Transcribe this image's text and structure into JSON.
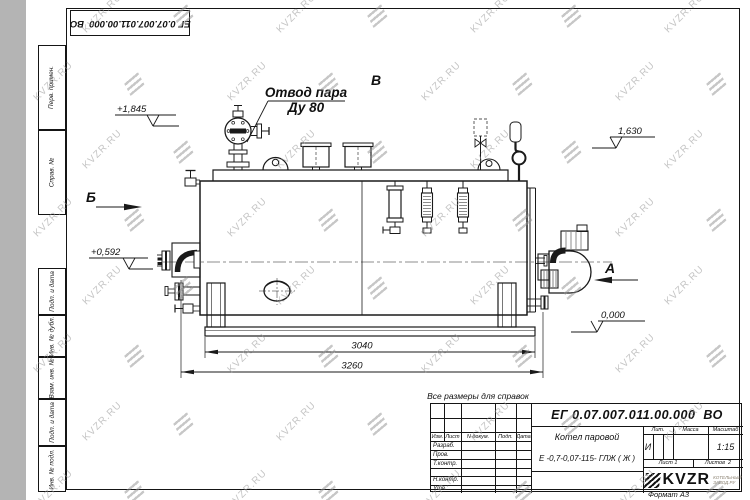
{
  "watermark": {
    "text": "KVZR.RU"
  },
  "corner_stamp": {
    "designation": "ЕГ 0.07.007.011.00.000  ВО"
  },
  "frame_columns": {
    "perv": "Перв. примен.",
    "sprav": "Справ. №",
    "podp1": "Подп. и дата",
    "inv_dubl": "Инв. № дубл.",
    "vzam": "Взам. инв. №",
    "podp2": "Подп. и дата",
    "inv_podl": "Инв. № подл."
  },
  "drawing": {
    "callout_line1": "Отвод пара",
    "callout_line2": "Ду 80",
    "view_b": "Б",
    "view_v": "В",
    "view_a": "А",
    "elev_top_left": "+1,845",
    "elev_mid_left": "+0,592",
    "elev_top_right": "1,630",
    "elev_zero": "0,000",
    "dim_inner": "3040",
    "dim_outer": "3260",
    "note": "Все размеры для справок"
  },
  "title_block": {
    "designation": "ЕГ 0.07.007.011.00.000  ВО",
    "product_name_line1": "Котел паровой",
    "product_name_line2": "Е -0,7-0,07-115- ГЛЖ ( Ж )",
    "col_izm": "Изм.",
    "col_list": "Лист",
    "col_doc": "N докум.",
    "col_podp": "Подп.",
    "col_data": "Дата",
    "row_razrab": "Разраб.",
    "row_prov": "Пров.",
    "row_tkontr": "Т.контр.",
    "row_nkontr": "Н.контр.",
    "row_utv": "Утв.",
    "lit_header": "Лит.",
    "mass_header": "Масса",
    "scale_header": "Масштаб",
    "lit_value": "И",
    "scale_value": "1:15",
    "sheet_info": "Лист 1",
    "sheets_info": "Листов  2",
    "brand": "KVZR",
    "brand_sub1": "КОТЕЛЬНЫЙ",
    "brand_sub2": "ЗАВОД.РУ",
    "format_label": "Формат А3"
  }
}
